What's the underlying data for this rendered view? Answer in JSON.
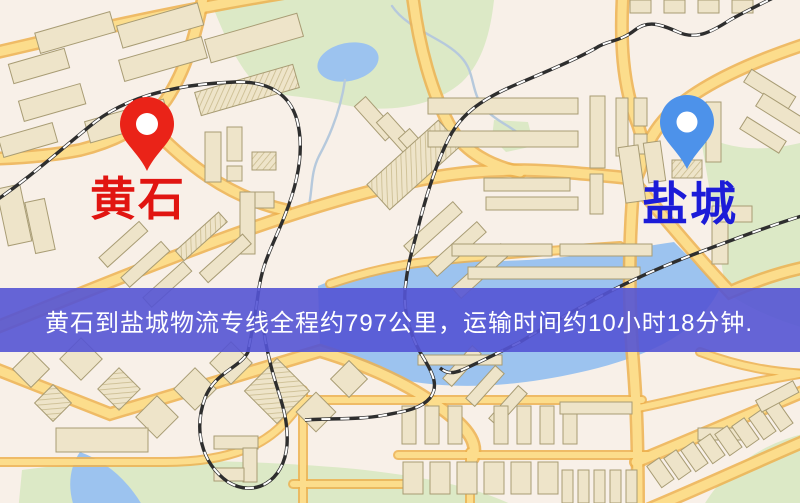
{
  "banner": {
    "text": "黄石到盐城物流专线全程约797公里，运输时间约10小时18分钟.",
    "distance_text": "约797公里",
    "duration_text": "约10小时18分钟",
    "background_color": "rgba(84,84,212,0.9)",
    "text_color": "#ffffff"
  },
  "markers": {
    "origin": {
      "label": "黄石",
      "label_color": "#e11511",
      "pin_color": "#ea2318",
      "icon": "map-pin"
    },
    "destination": {
      "label": "盐城",
      "label_color": "#1c1cd8",
      "pin_color": "#4d92ea",
      "icon": "map-pin"
    }
  },
  "map": {
    "palette": {
      "base": "#f8f0e8",
      "road_fill": "#fcdd8c",
      "road_casing": "#edb14f",
      "park": "#dce9c6",
      "water": "#9cc3ef",
      "building": "#eee4c9",
      "building_stroke": "#a89c74",
      "railway": "#2e2e2e"
    }
  }
}
